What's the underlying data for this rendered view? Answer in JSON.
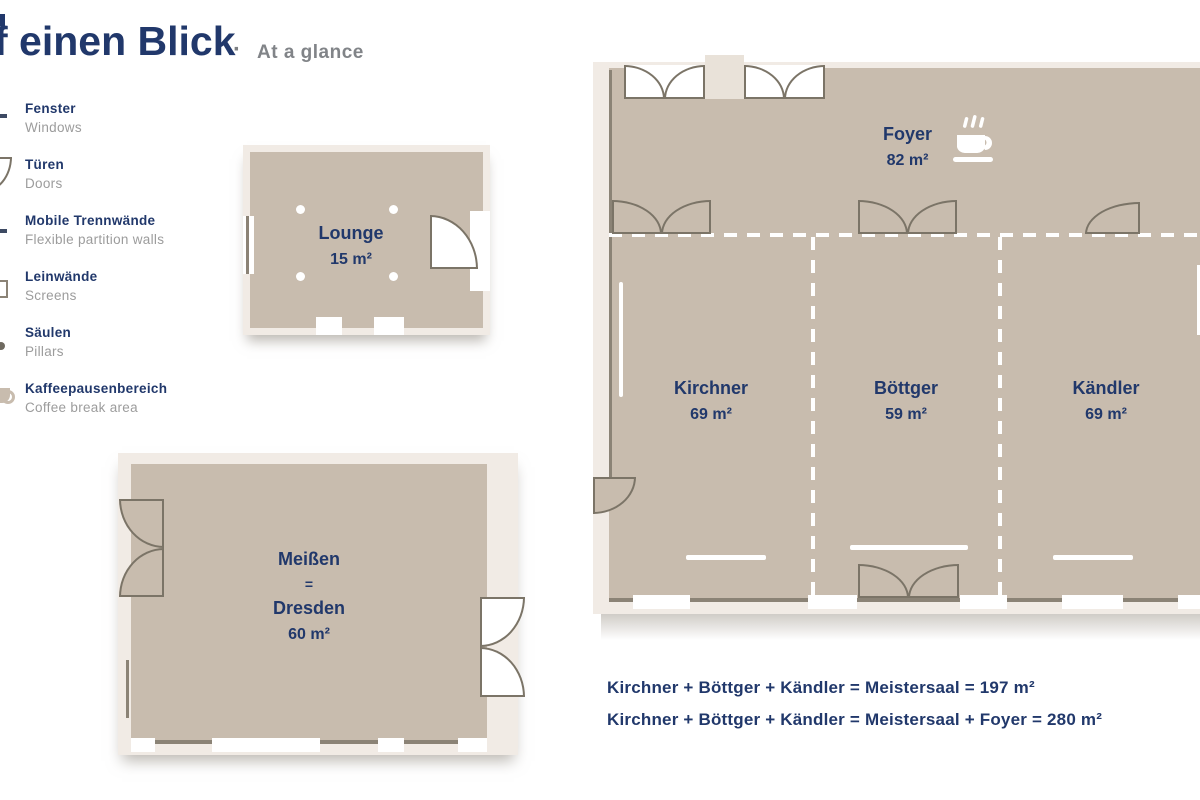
{
  "header": {
    "title": "f einen Blick",
    "separator": "·",
    "subtitle": "At a glance"
  },
  "legend": {
    "items": [
      {
        "icon": "window-icon",
        "de": "Fenster",
        "en": "Windows"
      },
      {
        "icon": "door-icon",
        "de": "Türen",
        "en": "Doors"
      },
      {
        "icon": "partition-icon",
        "de": "Mobile Trennwände",
        "en": "Flexible partition walls"
      },
      {
        "icon": "screen-icon",
        "de": "Leinwände",
        "en": "Screens"
      },
      {
        "icon": "pillar-icon",
        "de": "Säulen",
        "en": "Pillars"
      },
      {
        "icon": "coffee-icon",
        "de": "Kaffeepausenbereich",
        "en": "Coffee break area"
      }
    ]
  },
  "rooms": {
    "lounge": {
      "name": "Lounge",
      "area": "15 m²"
    },
    "meissen": {
      "name": "Meißen",
      "equals": "=",
      "name2": "Dresden",
      "area": "60 m²"
    },
    "foyer": {
      "name": "Foyer",
      "area": "82 m²"
    },
    "kirchner": {
      "name": "Kirchner",
      "area": "69 m²"
    },
    "boettger": {
      "name": "Böttger",
      "area": "59 m²"
    },
    "kaendler": {
      "name": "Kändler",
      "area": "69 m²"
    }
  },
  "summary": {
    "line1": "Kirchner + Böttger + Kändler = Meistersaal = 197 m²",
    "line2": "Kirchner + Böttger + Kändler = Meistersaal  + Foyer = 280 m²"
  },
  "colors": {
    "accent_navy": "#21386b",
    "floor_tan": "#c8bcae",
    "wall_light": "#f1ebe5",
    "door_outline": "#7b7467",
    "subtitle_gray": "#818488"
  }
}
